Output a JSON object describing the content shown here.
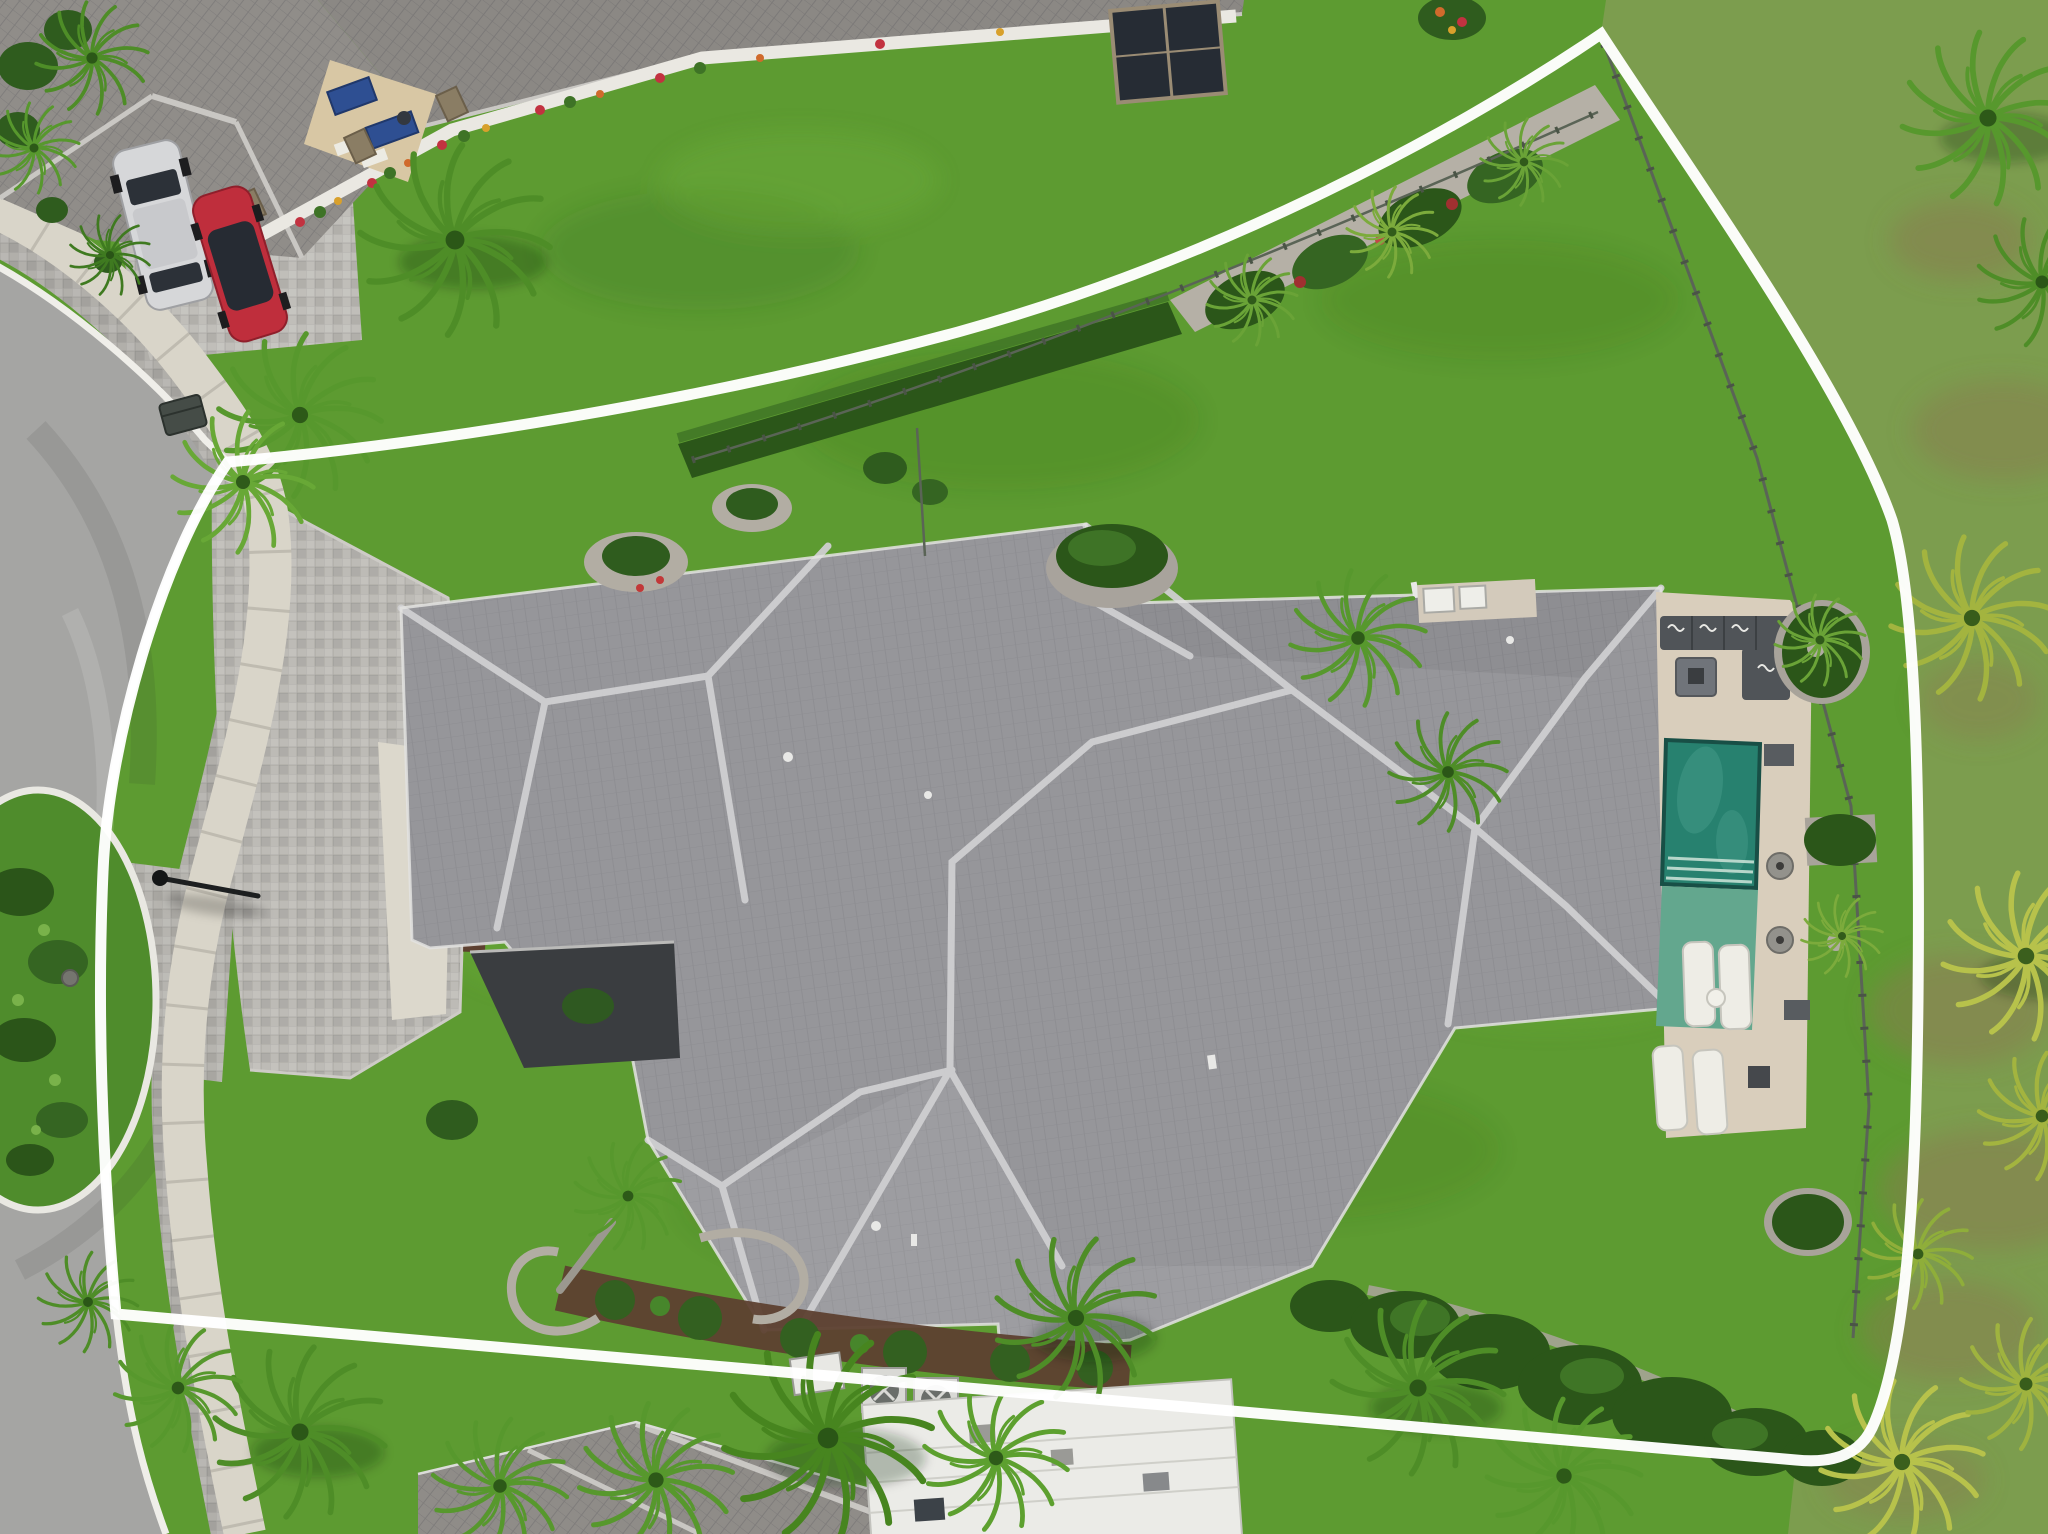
{
  "meta": {
    "description": "Top-down aerial drone photograph of a single-family residential lot outlined with a white property-boundary overlay; cul-de-sac street at left, large gray hip-roof house in center, pool and travertine deck at right, tropical landscaping throughout",
    "image_type": "aerial-photo",
    "overlay": "white lot boundary line"
  },
  "colors": {
    "lawn": "#5d9b31",
    "lawn_outside": "#7f9d52",
    "road_asphalt": "#a5a5a3",
    "curb": "#efeee9",
    "sidewalk": "#d9d5c9",
    "driveway_pavers": "#bdbbb6",
    "main_roof": "#96969a",
    "neighbor_roof": "#908d89",
    "roof_ridge": "#cbcbcd",
    "courtyard_dark": "#3a3d40",
    "boundary_line": "#ffffff",
    "pool_deck": "#d9cebc",
    "pool_water": "#27816f",
    "pool_ledge": "#63a78e",
    "hedge": "#2b5619",
    "palm_green": "#4e8d27",
    "palm_yellow": "#b7c24b",
    "mulch": "#5d4030",
    "gravel": "#b2ada3",
    "flat_roof_white": "#ebebe7",
    "furniture_gray": "#505458",
    "lounger_white": "#eeede6",
    "car_red": "#bf2e3c",
    "car_silver": "#d6d7d9"
  },
  "scene": {
    "boundary": {
      "label": "property-boundary-outline"
    },
    "street": {
      "label": "cul-de-sac-street"
    },
    "island": {
      "label": "landscaped-median-island"
    },
    "sidewalk": {
      "label": "concrete-sidewalk"
    },
    "neighbor_house": {
      "label": "neighboring-house-top-left"
    },
    "vehicles": [
      {
        "label": "silver-suv"
      },
      {
        "label": "red-car"
      }
    ],
    "main_house": {
      "label": "main-residence-hip-roof"
    },
    "entry_courtyard": {
      "label": "recessed-entry-courtyard"
    },
    "driveway": {
      "label": "paver-driveway"
    },
    "walkway": {
      "label": "front-entry-walkway"
    },
    "pool": {
      "label": "swimming-pool"
    },
    "tanning_ledge": {
      "label": "tanning-ledge-with-in-pool-loungers"
    },
    "pool_deck": {
      "label": "travertine-pool-deck"
    },
    "outdoor_living": {
      "label": "outdoor-sectional-and-fire-pit"
    },
    "pool_equipment": {
      "label": "pool-equipment-pad"
    },
    "fence": {
      "label": "perimeter-metal-fence"
    },
    "hedges": {
      "label": "perimeter-hedges-and-planting-beds"
    },
    "palms": {
      "label": "palm-trees"
    },
    "second_house": {
      "label": "bottom-neighbor-roof"
    },
    "flat_roof": {
      "label": "white-flat-roof-structure"
    },
    "ac_units": {
      "label": "ac-condenser-units"
    },
    "streetlight": {
      "label": "street-lamp"
    },
    "trash_bin": {
      "label": "trash-bin"
    }
  }
}
